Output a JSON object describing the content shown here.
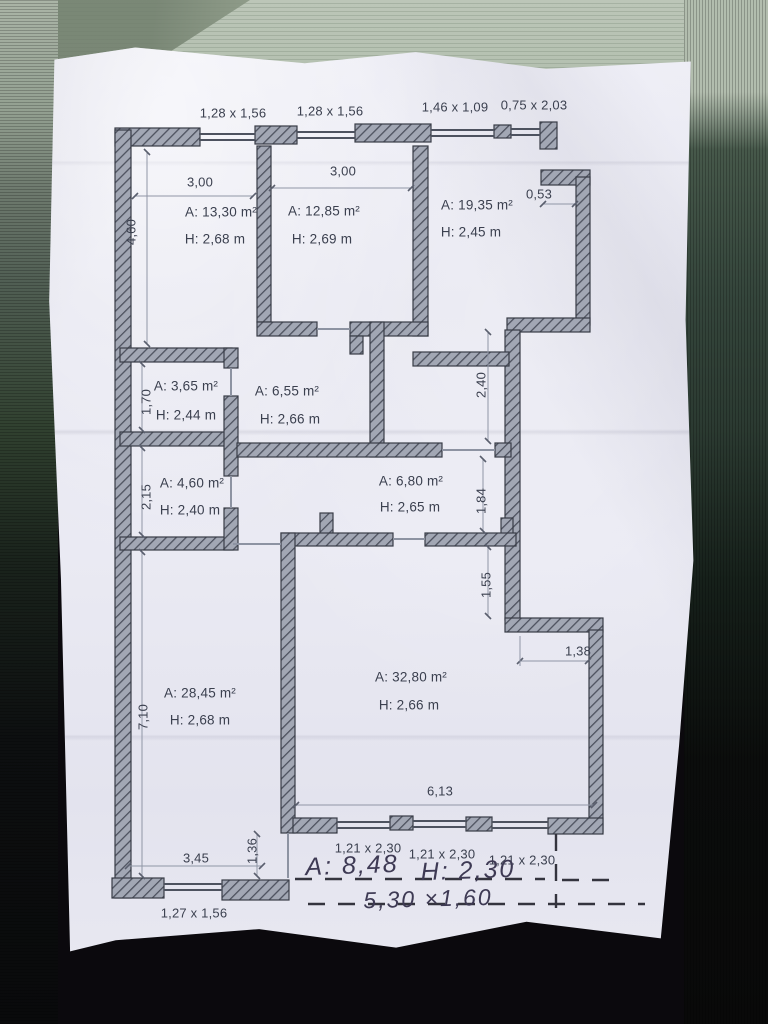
{
  "plan": {
    "top_windows": [
      "1,28 x 1,56",
      "1,28 x 1,56",
      "1,46 x 1,09",
      "0,75 x 2,03"
    ],
    "rooms": [
      {
        "area": "A: 13,30 m²",
        "height": "H: 2,68 m"
      },
      {
        "area": "A: 12,85 m²",
        "height": "H: 2,69 m"
      },
      {
        "area": "A: 19,35 m²",
        "height": "H: 2,45 m"
      },
      {
        "area": "A: 3,65 m²",
        "height": "H: 2,44 m"
      },
      {
        "area": "A: 6,55 m²",
        "height": "H: 2,66 m"
      },
      {
        "area": "A: 4,60 m²",
        "height": "H: 2,40 m"
      },
      {
        "area": "A: 6,80 m²",
        "height": "H: 2,65 m"
      },
      {
        "area": "A: 28,45 m²",
        "height": "H: 2,68 m"
      },
      {
        "area": "A: 32,80 m²",
        "height": "H: 2,66 m"
      }
    ],
    "dims": {
      "room1_width": "3,00",
      "room2_width": "3,00",
      "room1_depth": "4,60",
      "notch": "0,53",
      "v170": "1,70",
      "v215": "2,15",
      "v710": "7,10",
      "v240": "2,40",
      "v184": "1,84",
      "v155": "1,55",
      "h138": "1,38",
      "h613": "6,13",
      "h345": "3,45",
      "v136": "1,36"
    },
    "bottom_windows": [
      "1,21 x 2,30",
      "1,21 x 2,30",
      "1,21 x 2,30"
    ],
    "bottom_left_window": "1,27 x 1,56",
    "handwritten": {
      "area": "A: 8,48",
      "height": "H: 2,30",
      "size": "5,30 ×1,60"
    }
  },
  "colors": {
    "wall_fill": "#a2a7b4",
    "wall_hatch": "#4d515e",
    "ink": "#3b404f",
    "pen": "#3e3a54"
  }
}
